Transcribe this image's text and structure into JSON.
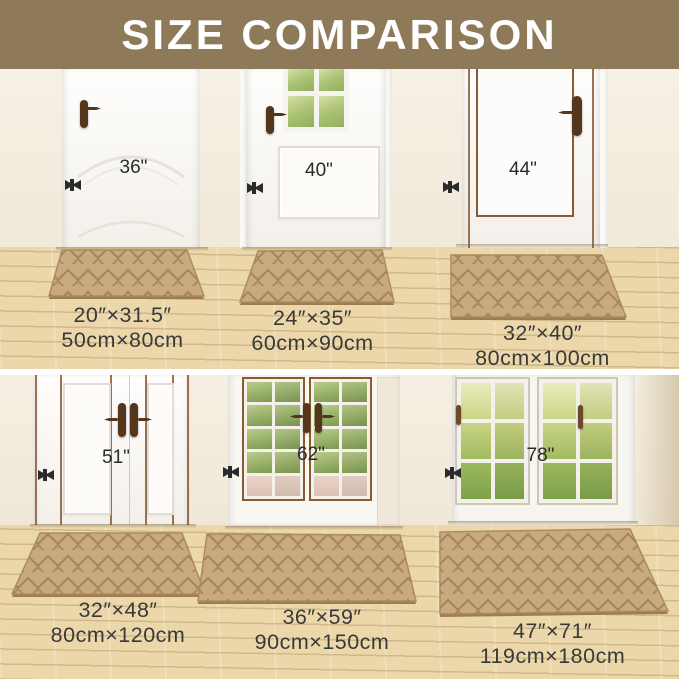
{
  "title": "SIZE COMPARISON",
  "colors": {
    "banner": "#8e7a58",
    "wall": "#f4eee1",
    "floor": "#ebd7aa",
    "mat": "#c9aa7f",
    "mat_pattern_line": "#a2855b",
    "label_text": "#3a3a3a",
    "arrow": "#2b2b2b",
    "door_trim_brown": "#8a5a32"
  },
  "panels": [
    {
      "scene": "single-panel-door",
      "door_width": "36\"",
      "mat_inches": "20″×31.5″",
      "mat_cm": "50cm×80cm"
    },
    {
      "scene": "glazed-entry-door",
      "door_width": "40\"",
      "mat_inches": "24″×35″",
      "mat_cm": "60cm×90cm"
    },
    {
      "scene": "brown-trimmed-door",
      "door_width": "44\"",
      "mat_inches": "32″×40″",
      "mat_cm": "80cm×100cm"
    },
    {
      "scene": "double-panel-doors",
      "door_width": "51\"",
      "mat_inches": "32″×48″",
      "mat_cm": "80cm×120cm"
    },
    {
      "scene": "french-glass-doors",
      "door_width": "62\"",
      "mat_inches": "36″×59″",
      "mat_cm": "90cm×150cm"
    },
    {
      "scene": "patio-sliding-doors",
      "door_width": "78\"",
      "mat_inches": "47″×71″",
      "mat_cm": "119cm×180cm"
    }
  ]
}
